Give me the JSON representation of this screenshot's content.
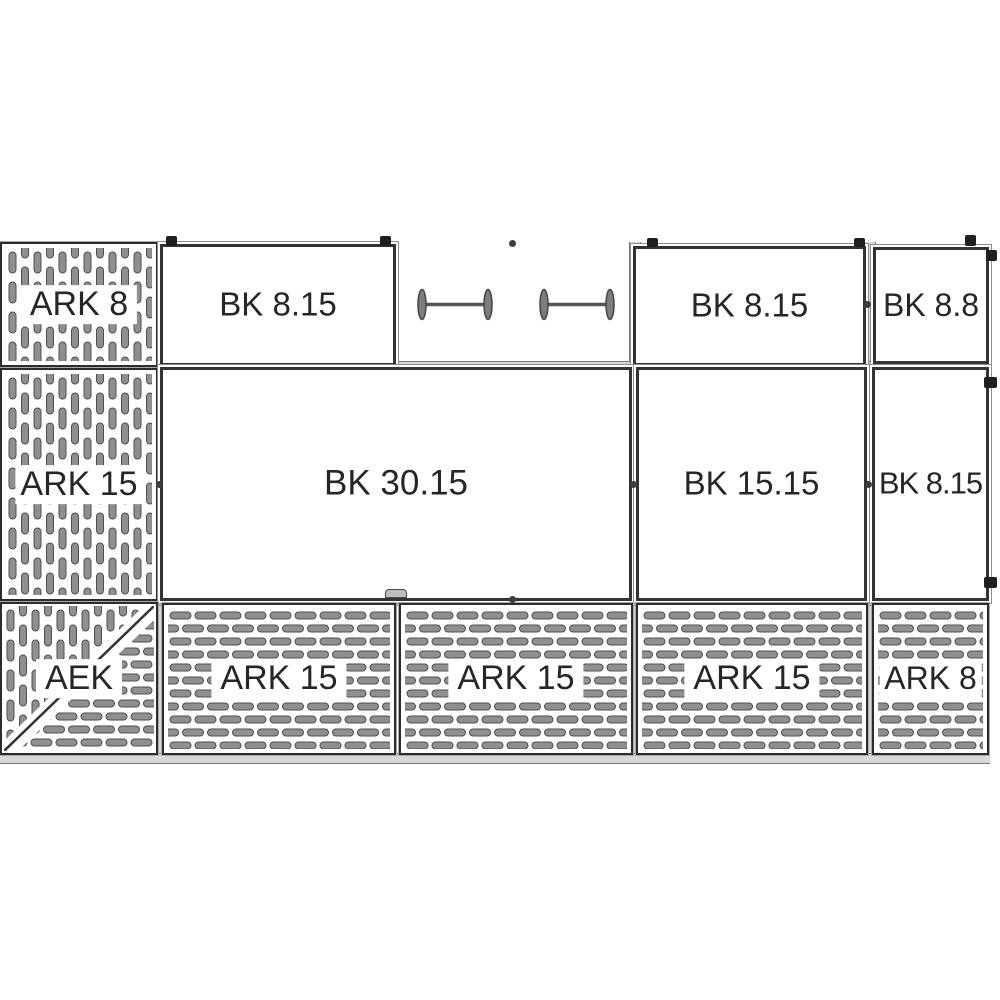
{
  "diagram": {
    "kind": "panel-assembly-technical-drawing",
    "colors": {
      "background": "#ffffff",
      "line": "#2c2c2c",
      "perforation_fill": "#8f8f8f",
      "perforation_stroke": "#4f4f4f",
      "rail_fill": "#d8d8d8",
      "label_text": "#262626"
    },
    "panels": [
      {
        "label": "ARK 8",
        "position": "top-left",
        "style": "perforated-vertical-slots"
      },
      {
        "label": "BK 8.15",
        "position": "top-row-left",
        "style": "plain"
      },
      {
        "label": "BK 8.15",
        "position": "top-row-right",
        "style": "plain"
      },
      {
        "label": "BK 8.8",
        "position": "top-far-right",
        "style": "plain"
      },
      {
        "label": "ARK 15",
        "position": "middle-left",
        "style": "perforated-vertical-slots"
      },
      {
        "label": "BK 30.15",
        "position": "middle-center",
        "style": "plain"
      },
      {
        "label": "BK 15.15",
        "position": "middle-right",
        "style": "plain"
      },
      {
        "label": "BK 8.15",
        "position": "middle-far-right",
        "style": "plain"
      },
      {
        "label": "AEK",
        "position": "bottom-left",
        "style": "perforated-corner-mixed-diagonal"
      },
      {
        "label": "ARK 15",
        "position": "bottom-row-1",
        "style": "perforated-horizontal-dashes"
      },
      {
        "label": "ARK 15",
        "position": "bottom-row-2",
        "style": "perforated-horizontal-dashes"
      },
      {
        "label": "ARK 15",
        "position": "bottom-row-3",
        "style": "perforated-horizontal-dashes"
      },
      {
        "label": "ARK 8",
        "position": "bottom-right",
        "style": "perforated-horizontal-dashes"
      }
    ],
    "connectors": {
      "count": 2,
      "type": "spacer-bar"
    }
  }
}
